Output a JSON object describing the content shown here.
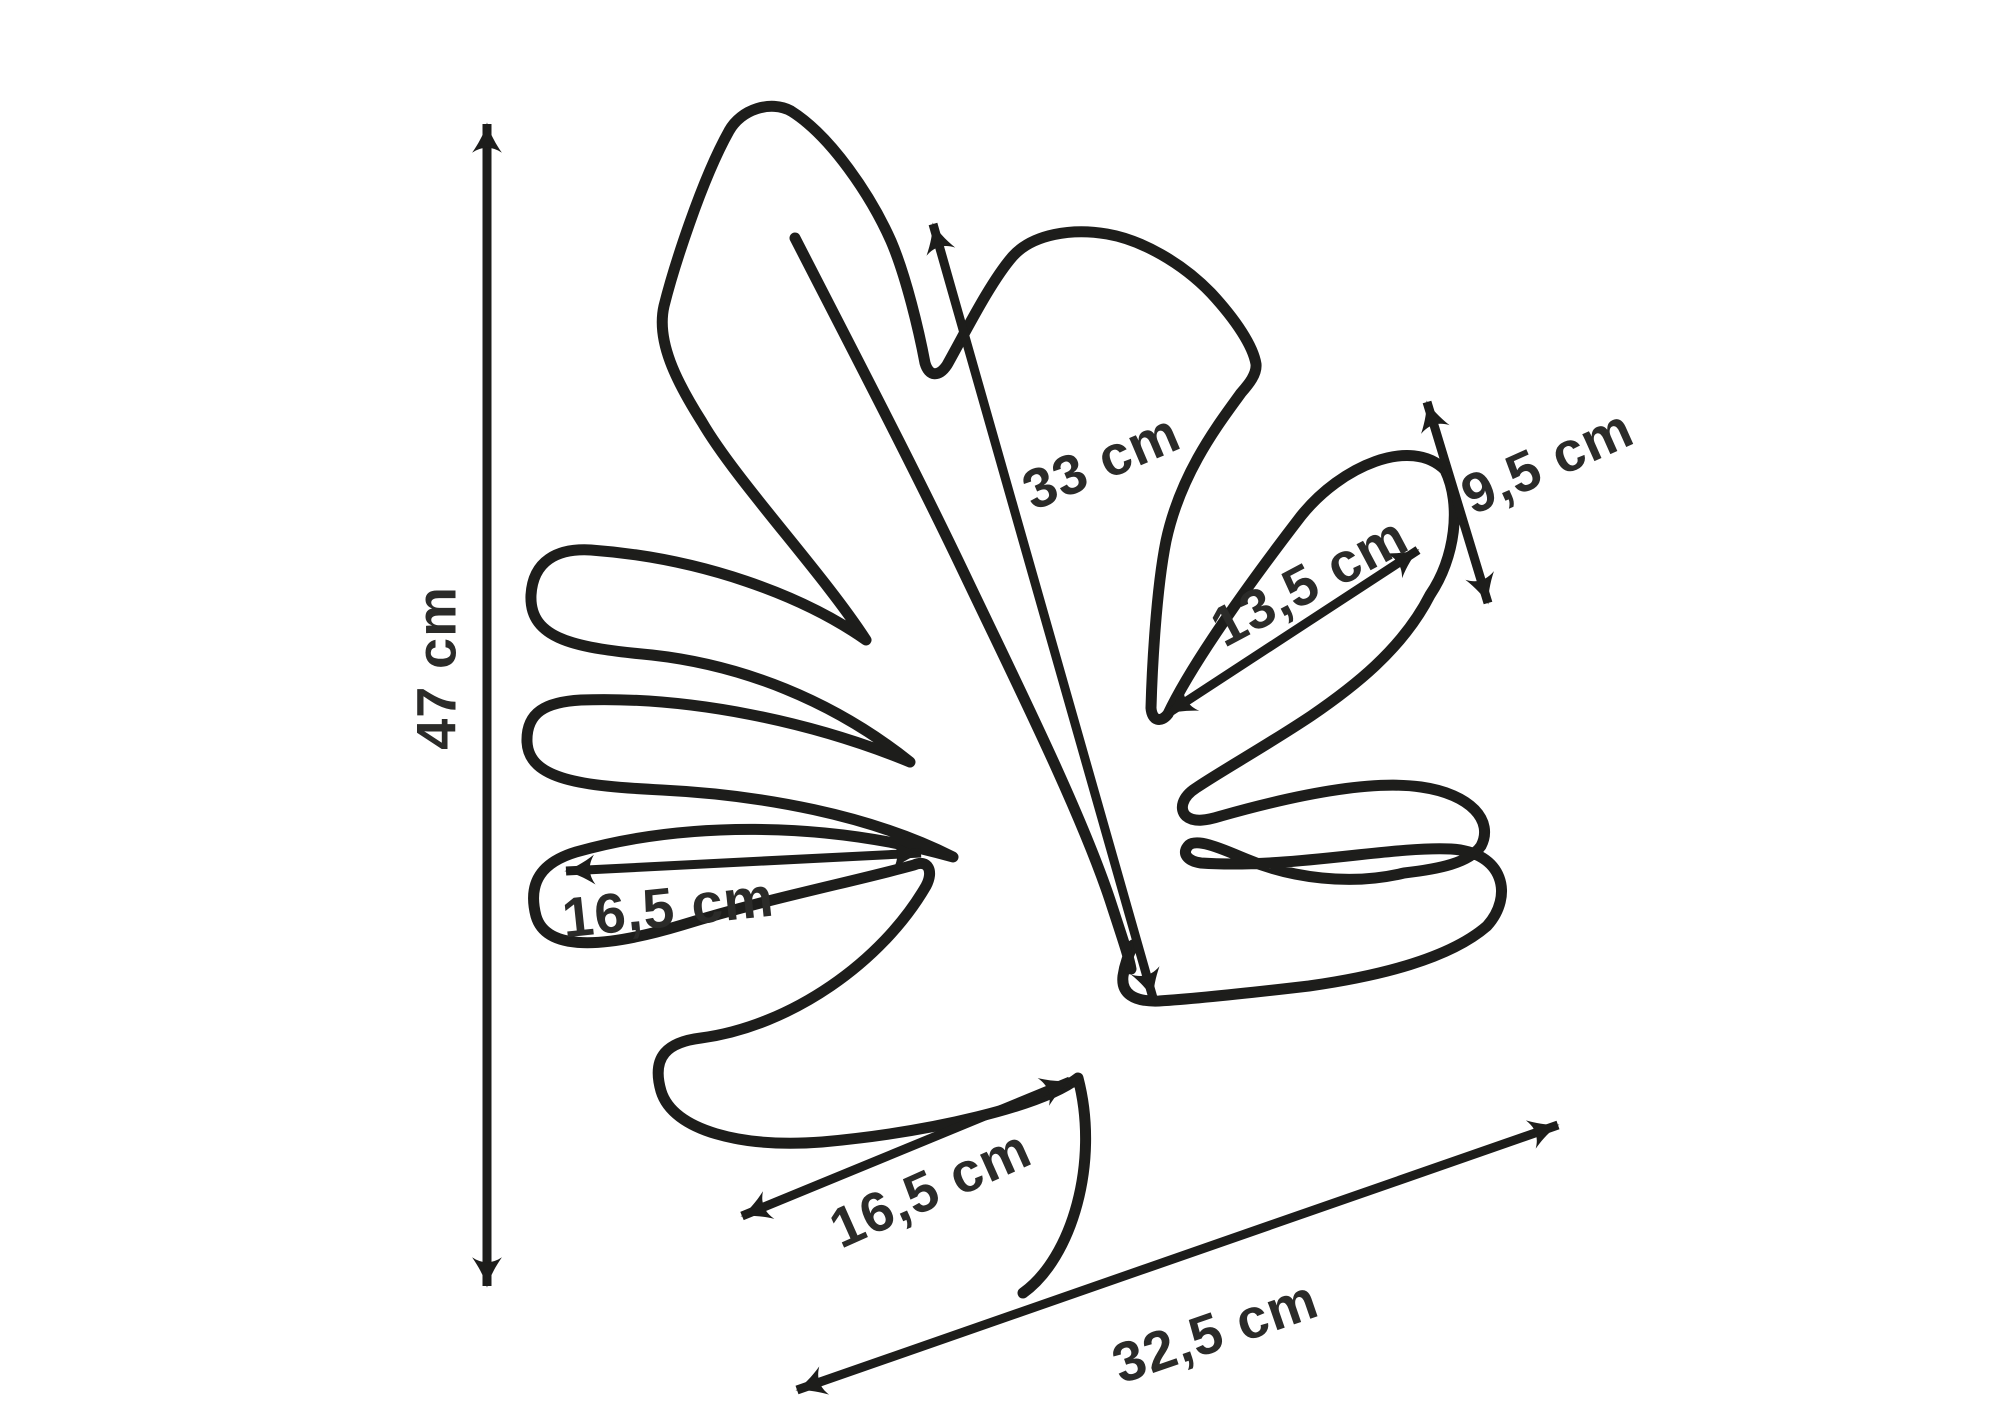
{
  "figure": {
    "type": "pattern-diagram",
    "subject": "monstera-leaf-template",
    "unit": "cm"
  },
  "measurements": [
    {
      "id": "overall-height",
      "label": "47 cm",
      "value": 47,
      "orientation": "vertical-left"
    },
    {
      "id": "center-vein-length",
      "label": "33 cm",
      "value": 33,
      "orientation": "diagonal-center"
    },
    {
      "id": "right-lobe-width",
      "label": "9,5 cm",
      "value": 9.5,
      "orientation": "vertical-right"
    },
    {
      "id": "right-lobe-length",
      "label": "13,5 cm",
      "value": 13.5,
      "orientation": "diagonal-right"
    },
    {
      "id": "left-middle-lobe-length",
      "label": "16,5 cm",
      "value": 16.5,
      "orientation": "horizontal-left"
    },
    {
      "id": "bottom-lobe-length",
      "label": "16,5 cm",
      "value": 16.5,
      "orientation": "diagonal-bottom"
    },
    {
      "id": "overall-width",
      "label": "32,5 cm",
      "value": 32.5,
      "orientation": "diagonal-bottom-right"
    }
  ],
  "colors": {
    "line": "#1d1d1b",
    "text": "#2b2b29",
    "background": "#ffffff"
  }
}
